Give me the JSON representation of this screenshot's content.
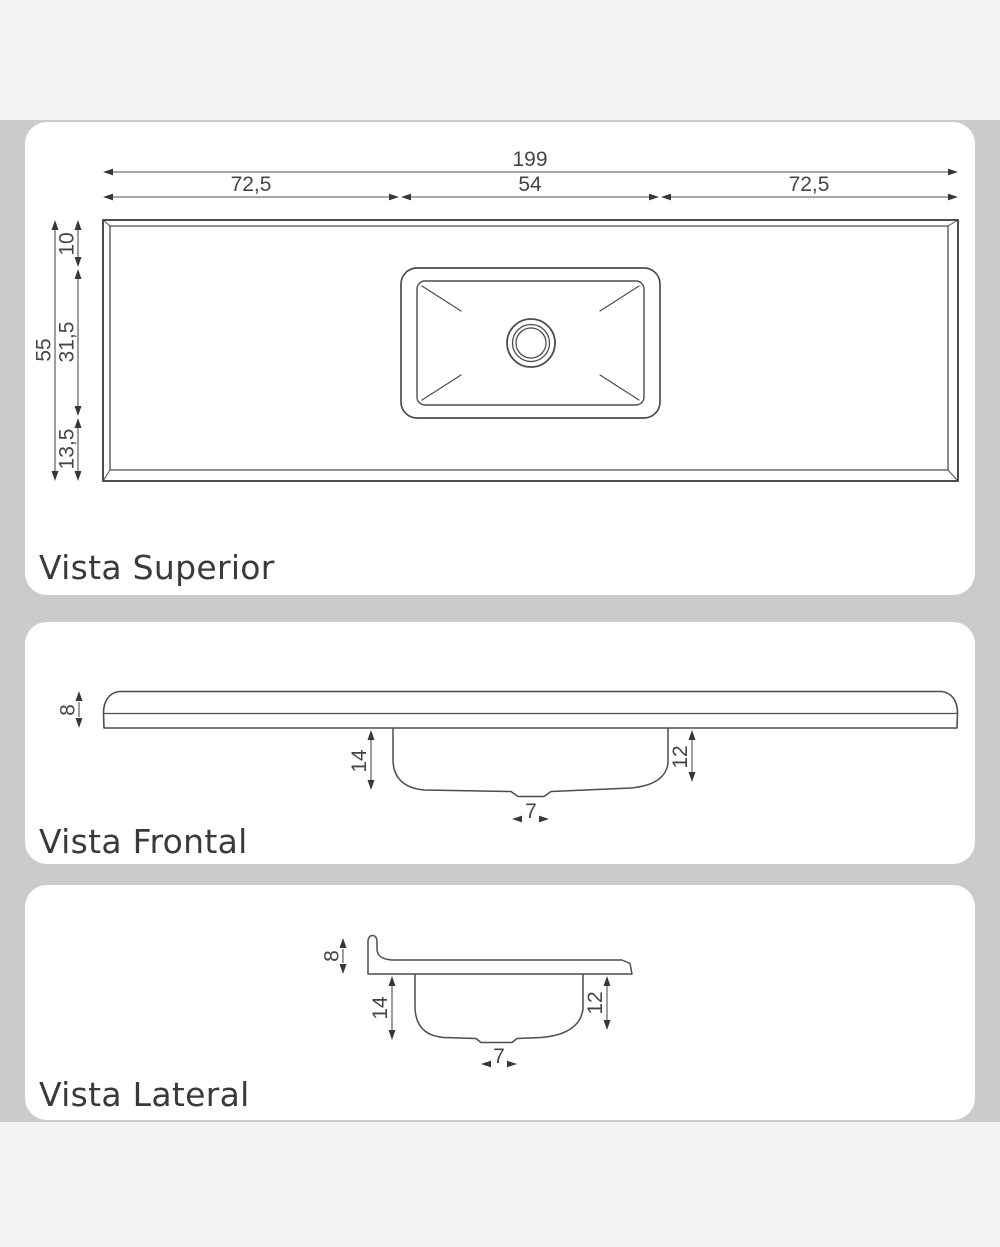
{
  "colors": {
    "background_mid": "#cbcbcb",
    "background_bands": "#f2f2f2",
    "panel": "#ffffff",
    "line": "#4d4d4d",
    "dimension_text": "#454545",
    "label_text": "#3a3a3a"
  },
  "views": {
    "superior": {
      "label": "Vista Superior",
      "dims": {
        "total_width": "199",
        "left_segment": "72,5",
        "center_segment": "54",
        "right_segment": "72,5",
        "total_depth": "55",
        "top_offset": "10",
        "basin_depth": "31,5",
        "bottom_offset": "13,5"
      }
    },
    "frontal": {
      "label": "Vista Frontal",
      "dims": {
        "thickness": "8",
        "left_bowl_depth": "14",
        "right_bowl_depth": "12",
        "drain_width": "7"
      }
    },
    "lateral": {
      "label": "Vista Lateral",
      "dims": {
        "thickness": "8",
        "left_bowl_depth": "14",
        "right_bowl_depth": "12",
        "drain_width": "7"
      }
    }
  }
}
